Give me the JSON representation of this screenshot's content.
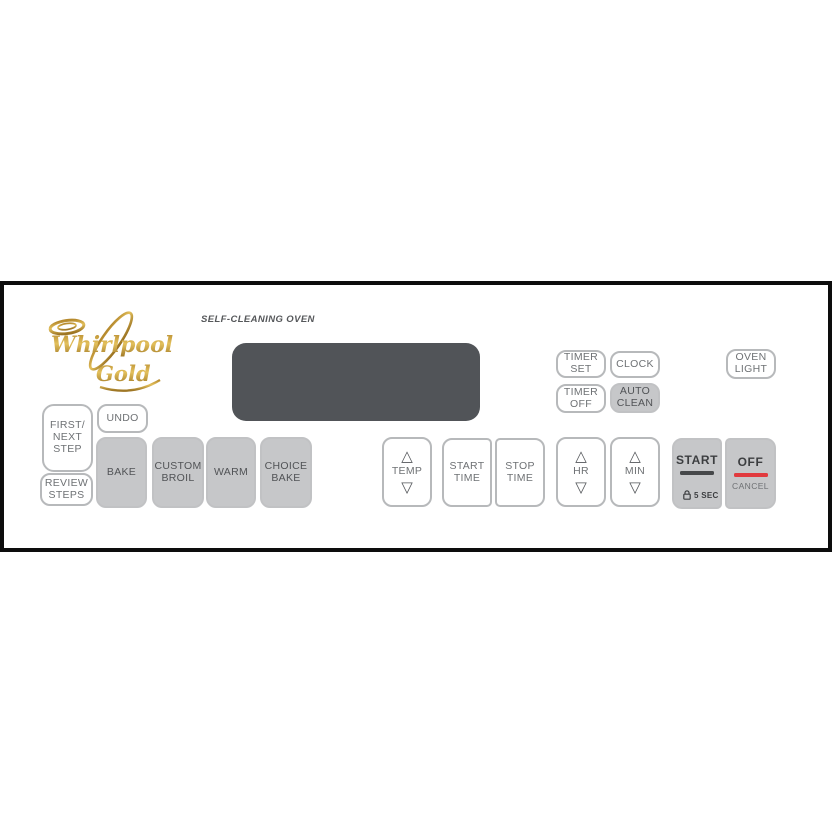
{
  "brand": {
    "name": "Whirlpool",
    "series": "Gold"
  },
  "panel_label": "SELF-CLEANING OVEN",
  "display": {
    "value": ""
  },
  "colors": {
    "frame_black": "#0d0d0d",
    "display_bg": "#515458",
    "key_gray": "#c6c7c9",
    "key_border": "#b7b9bb",
    "key_text": "#6e7174",
    "dark_text": "#3c3e40",
    "accent_red": "#e13a3e",
    "brand_gold": "#c49a3c"
  },
  "icons": {
    "up": "△",
    "down": "▽",
    "lock": "padlock"
  },
  "buttons": {
    "timer_set": {
      "label": "TIMER\nSET"
    },
    "clock": {
      "label": "CLOCK"
    },
    "timer_off": {
      "label": "TIMER\nOFF"
    },
    "auto_clean": {
      "label": "AUTO\nCLEAN"
    },
    "oven_light": {
      "label": "OVEN\nLIGHT"
    },
    "first_next_step": {
      "label": "FIRST/\nNEXT\nSTEP"
    },
    "undo": {
      "label": "UNDO"
    },
    "review_steps": {
      "label": "REVIEW\nSTEPS"
    },
    "bake": {
      "label": "BAKE"
    },
    "custom_broil": {
      "label": "CUSTOM\nBROIL"
    },
    "warm": {
      "label": "WARM"
    },
    "choice_bake": {
      "label": "CHOICE\nBAKE"
    },
    "temp": {
      "label": "TEMP"
    },
    "start_time": {
      "label": "START\nTIME"
    },
    "stop_time": {
      "label": "STOP\nTIME"
    },
    "hr": {
      "label": "HR"
    },
    "min": {
      "label": "MIN"
    },
    "start": {
      "label": "START",
      "hold_hint": "5 SEC"
    },
    "off": {
      "label": "OFF",
      "sub_label": "CANCEL"
    }
  }
}
